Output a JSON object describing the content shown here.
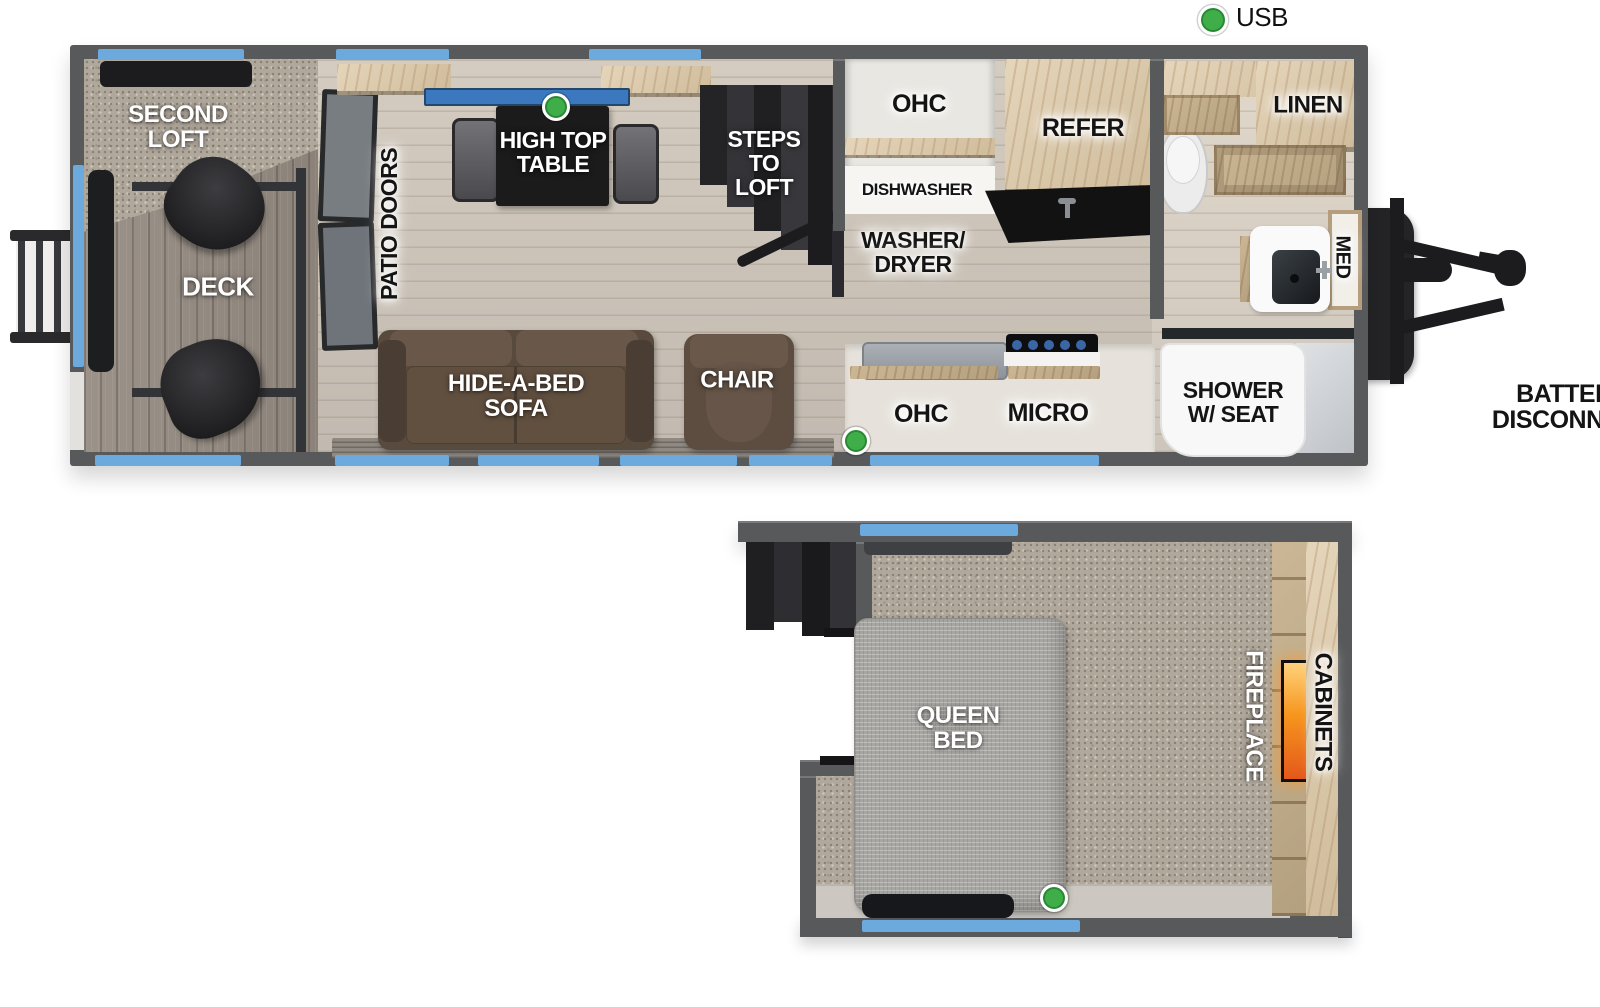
{
  "legend": {
    "usb": "USB"
  },
  "colors": {
    "wall_gray": "#58595b",
    "window_accent_blue": "#6ca9dc",
    "usb_indicator_green": "#3fae49",
    "fireplace_flame_orange": "#f6951d"
  },
  "main_floor": {
    "second_loft": "SECOND LOFT",
    "deck": "DECK",
    "patio_doors": "PATIO DOORS",
    "high_top_table": "HIGH TOP TABLE",
    "steps_to_loft": "STEPS TO LOFT",
    "hide_a_bed_sofa": "HIDE-A-BED SOFA",
    "chair": "CHAIR",
    "ohc_top": "OHC",
    "dishwasher": "DISHWASHER",
    "washer_dryer": "WASHER/ DRYER",
    "refer": "REFER",
    "linen": "LINEN",
    "med": "MED",
    "ohc_bottom": "OHC",
    "micro": "MICRO",
    "shower": "SHOWER W/ SEAT",
    "battery_disconnect": "BATTERY DISCONNECT"
  },
  "loft": {
    "queen_bed": "QUEEN BED",
    "fireplace": "FIREPLACE",
    "cabinets": "CABINETS"
  }
}
